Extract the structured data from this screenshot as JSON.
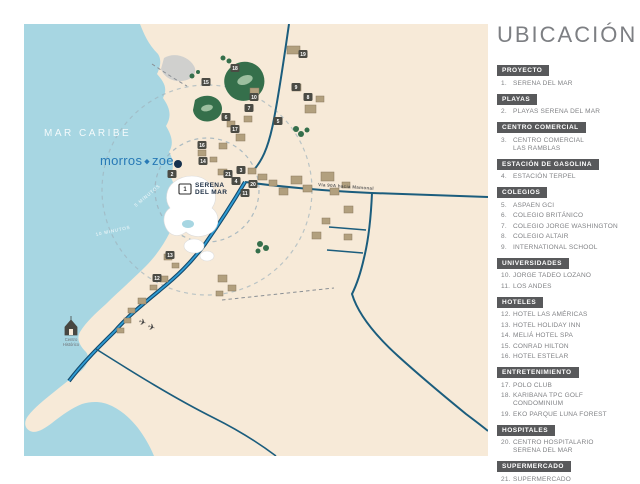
{
  "title": "UBICACIÓN",
  "colors": {
    "sea": "#a7d6e2",
    "land": "#f7ead8",
    "lagoon-gray": "#c9cbcd",
    "road": "#1b5d7d",
    "highway": "#2f9cd4",
    "highway-casing": "#14496b",
    "golf": "#356f4b",
    "golf-light": "#9cbf9f",
    "building": "#b2a07e",
    "building-dark": "#8a7a5e",
    "marker-bg": "#4b4b44",
    "legend-bar": "#58595b",
    "legend-text": "#808285",
    "title-gray": "#7d7f83",
    "logo-blue": "#2779b6",
    "navy": "#16314e"
  },
  "map": {
    "sea_label": "MAR CARIBE",
    "logo_left": "morros",
    "logo_diamond": "◆",
    "logo_right": "zoe",
    "project_label_line1": "SERENA",
    "project_label_line2": "DEL MAR",
    "road_label": "Vía 90A hacia Mamonal",
    "ring_labels": [
      "5 MINUTOS",
      "10 MINUTOS"
    ],
    "historic_center_line1": "Centro",
    "historic_center_line2": "Histórico",
    "markers": [
      {
        "n": "1",
        "x": 161,
        "y": 165
      },
      {
        "n": "2",
        "x": 148,
        "y": 150
      },
      {
        "n": "3",
        "x": 217,
        "y": 146
      },
      {
        "n": "4",
        "x": 212,
        "y": 157
      },
      {
        "n": "5",
        "x": 254,
        "y": 97
      },
      {
        "n": "6",
        "x": 202,
        "y": 93
      },
      {
        "n": "7",
        "x": 225,
        "y": 84
      },
      {
        "n": "8",
        "x": 284,
        "y": 73
      },
      {
        "n": "9",
        "x": 272,
        "y": 63
      },
      {
        "n": "10",
        "x": 230,
        "y": 73
      },
      {
        "n": "11",
        "x": 221,
        "y": 169
      },
      {
        "n": "12",
        "x": 133,
        "y": 254
      },
      {
        "n": "13",
        "x": 146,
        "y": 231
      },
      {
        "n": "14",
        "x": 179,
        "y": 137
      },
      {
        "n": "15",
        "x": 182,
        "y": 58
      },
      {
        "n": "16",
        "x": 178,
        "y": 121
      },
      {
        "n": "17",
        "x": 211,
        "y": 105
      },
      {
        "n": "18",
        "x": 211,
        "y": 44
      },
      {
        "n": "19",
        "x": 279,
        "y": 30
      },
      {
        "n": "20",
        "x": 229,
        "y": 160
      },
      {
        "n": "21",
        "x": 204,
        "y": 150
      }
    ]
  },
  "legend": {
    "sections": [
      {
        "title": "PROYECTO",
        "items": [
          {
            "n": "1.",
            "label": "SERENA DEL MAR"
          }
        ]
      },
      {
        "title": "PLAYAS",
        "items": [
          {
            "n": "2.",
            "label": "PLAYAS SERENA DEL MAR"
          }
        ]
      },
      {
        "title": "CENTRO COMERCIAL",
        "items": [
          {
            "n": "3.",
            "label": "CENTRO COMERCIAL\nLAS RAMBLAS"
          }
        ]
      },
      {
        "title": "ESTACIÓN DE GASOLINA",
        "items": [
          {
            "n": "4.",
            "label": "ESTACIÓN TERPEL"
          }
        ]
      },
      {
        "title": "COLEGIOS",
        "items": [
          {
            "n": "5.",
            "label": "ASPAEN GCI"
          },
          {
            "n": "6.",
            "label": "COLEGIO BRITÁNICO"
          },
          {
            "n": "7.",
            "label": "COLEGIO JORGE WASHINGTON"
          },
          {
            "n": "8.",
            "label": "COLEGIO ALTAIR"
          },
          {
            "n": "9.",
            "label": "INTERNATIONAL SCHOOL"
          }
        ]
      },
      {
        "title": "UNIVERSIDADES",
        "items": [
          {
            "n": "10.",
            "label": "JORGE TADEO LOZANO"
          },
          {
            "n": "11.",
            "label": "LOS ANDES"
          }
        ]
      },
      {
        "title": "HOTELES",
        "items": [
          {
            "n": "12.",
            "label": "HOTEL LAS AMÉRICAS"
          },
          {
            "n": "13.",
            "label": "HOTEL HOLIDAY INN"
          },
          {
            "n": "14.",
            "label": "MELIÁ HOTEL SPA"
          },
          {
            "n": "15.",
            "label": "CONRAD HILTON"
          },
          {
            "n": "16.",
            "label": "HOTEL ESTELAR"
          }
        ]
      },
      {
        "title": "ENTRETENIMIENTO",
        "items": [
          {
            "n": "17.",
            "label": "POLO CLUB"
          },
          {
            "n": "18.",
            "label": "KARIBANA TPC GOLF\nCONDOMINIUM"
          },
          {
            "n": "19.",
            "label": "EKO PARQUE LUNA FOREST"
          }
        ]
      },
      {
        "title": "HOSPITALES",
        "items": [
          {
            "n": "20.",
            "label": "CENTRO HOSPITALARIO\nSERENA DEL MAR"
          }
        ]
      },
      {
        "title": "SUPERMERCADO",
        "items": [
          {
            "n": "21.",
            "label": "SUPERMERCADO"
          }
        ]
      }
    ]
  }
}
